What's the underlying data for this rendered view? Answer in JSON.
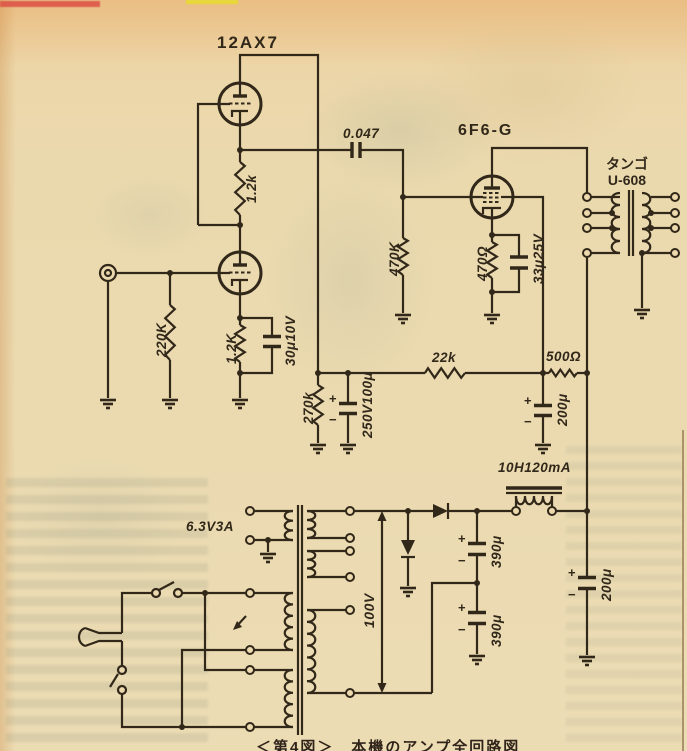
{
  "schematic": {
    "tubes": {
      "v1": "12AX7",
      "v2": "6F6-G"
    },
    "output_transformer": {
      "brand": "タンゴ",
      "model": "U-608"
    },
    "capacitors": {
      "coupling": "0.047",
      "cathode1": "30μ10V",
      "cathode2": "33μ25V",
      "b_filter1": "250V100μ",
      "screen_filter": "200μ",
      "main_filter": "200μ",
      "doubler1": "390μ",
      "doubler2": "390μ"
    },
    "resistors": {
      "srpp": "1.2k",
      "grid1": "220K",
      "cathode1": "1.2K",
      "grid2": "470K",
      "cathode2": "470Ω",
      "dropper1": "270k",
      "dropper2": "22k",
      "dropper3": "500Ω"
    },
    "choke": "10H120mA",
    "heater_winding": "6.3V3A",
    "mains_voltage": "100V",
    "plus": "+",
    "minus": "−"
  },
  "caption": "＜第4図＞　本機のアンプ全回路図"
}
